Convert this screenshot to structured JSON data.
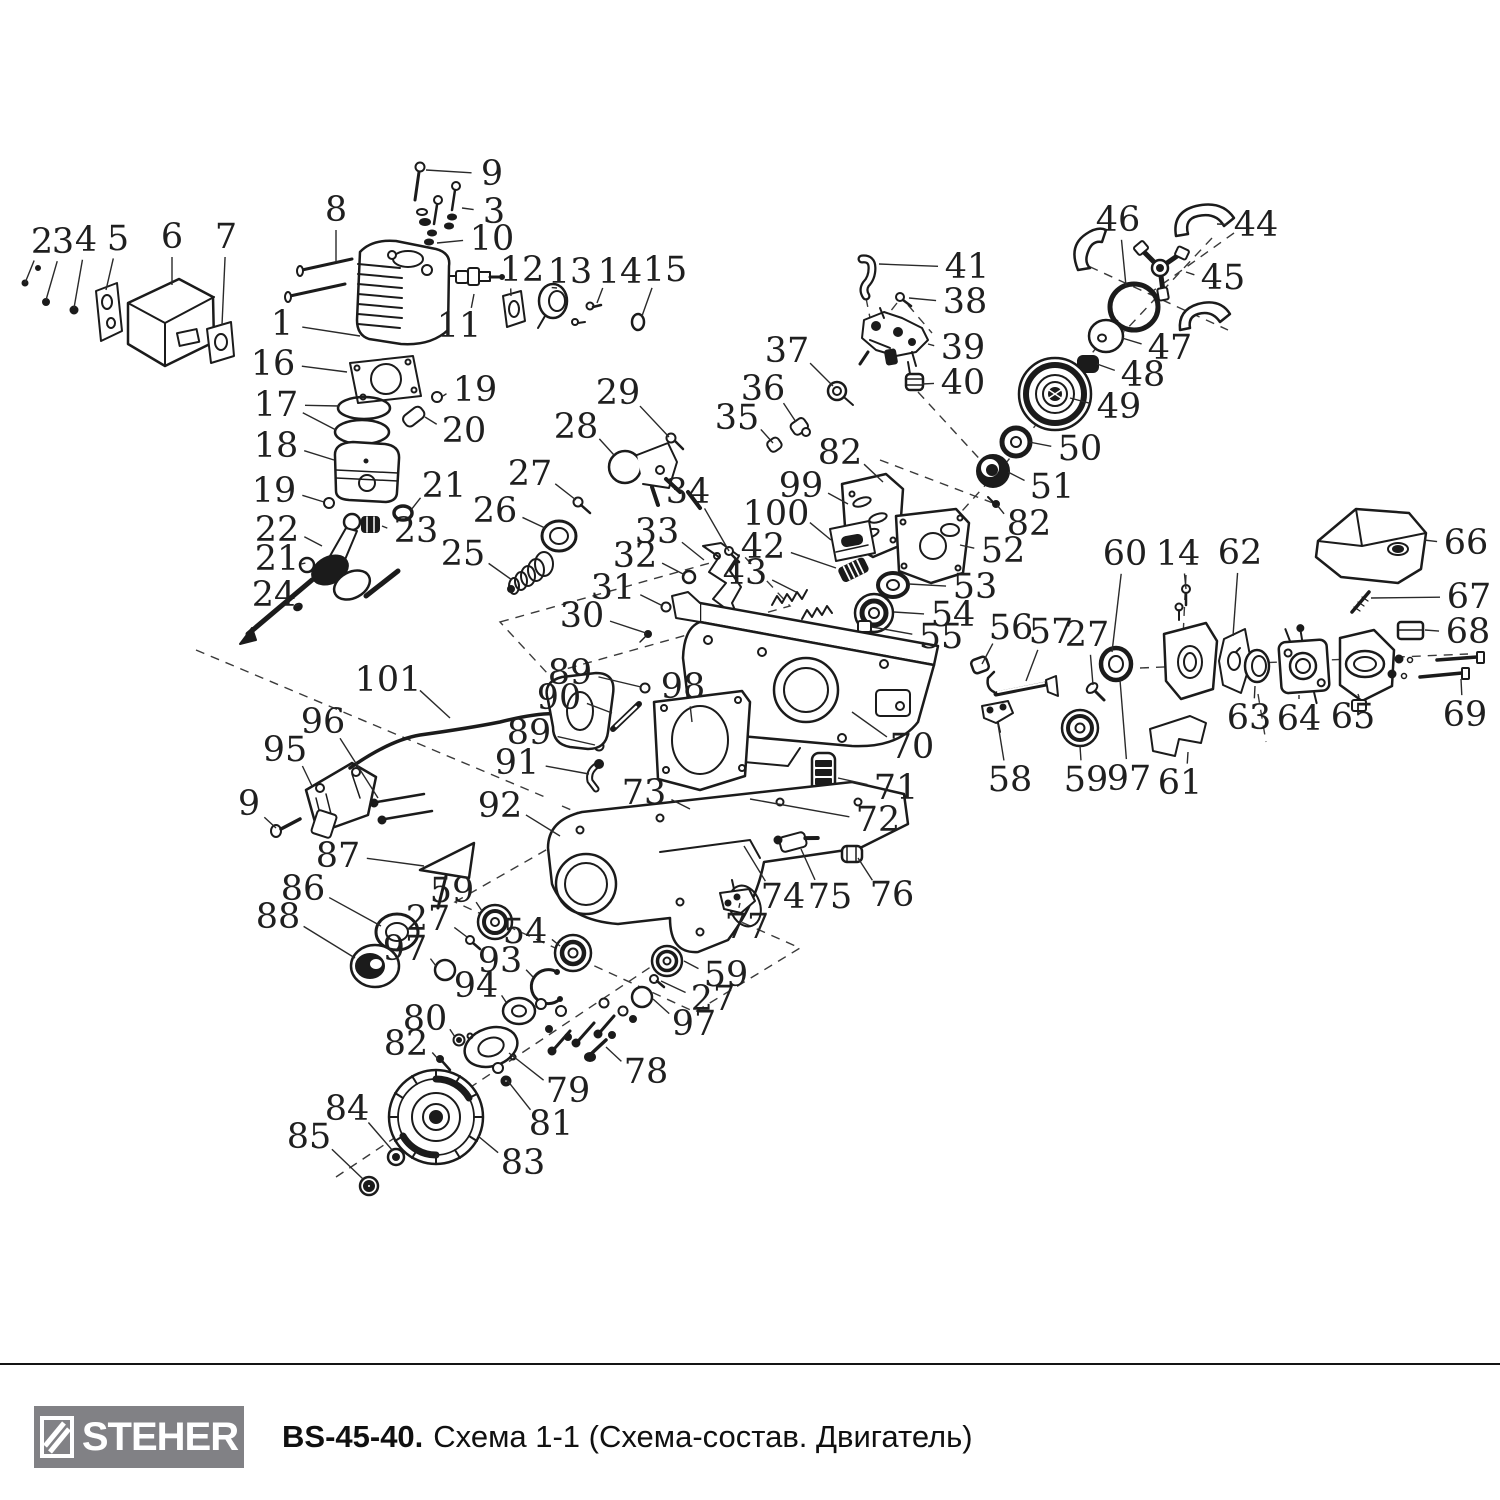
{
  "page": {
    "background": "#ffffff",
    "ink": "#1b1b1b"
  },
  "footer": {
    "brand": "STEHER",
    "model": "BS-45-40.",
    "title": "Схема 1-1 (Схема-состав. Двигатель)",
    "badge_color": "#818185",
    "rule_color": "#141414"
  },
  "diagram": {
    "description": "Exploded parts schematic of chainsaw engine (Двигатель) with numbered callouts",
    "callouts": [
      {
        "n": "2",
        "x": 42,
        "y": 242,
        "t": [
          [
            25,
            283
          ]
        ]
      },
      {
        "n": "3",
        "x": 63,
        "y": 242,
        "t": [
          [
            46,
            300
          ]
        ]
      },
      {
        "n": "4",
        "x": 86,
        "y": 240,
        "t": [
          [
            74,
            308
          ]
        ]
      },
      {
        "n": "5",
        "x": 118,
        "y": 239,
        "t": [
          [
            106,
            290
          ]
        ]
      },
      {
        "n": "6",
        "x": 172,
        "y": 237,
        "t": [
          [
            172,
            285
          ]
        ]
      },
      {
        "n": "7",
        "x": 226,
        "y": 237,
        "t": [
          [
            222,
            325
          ]
        ]
      },
      {
        "n": "8",
        "x": 336,
        "y": 210,
        "t": [
          [
            336,
            262
          ]
        ]
      },
      {
        "n": "9",
        "x": 492,
        "y": 174,
        "t": [
          [
            426,
            170
          ]
        ]
      },
      {
        "n": "3",
        "x": 494,
        "y": 212,
        "t": [
          [
            462,
            208
          ]
        ]
      },
      {
        "n": "10",
        "x": 492,
        "y": 239,
        "t": [
          [
            437,
            243
          ]
        ]
      },
      {
        "n": "1",
        "x": 282,
        "y": 324,
        "t": [
          [
            360,
            336
          ]
        ]
      },
      {
        "n": "11",
        "x": 459,
        "y": 326,
        "t": [
          [
            474,
            294
          ]
        ]
      },
      {
        "n": "12",
        "x": 522,
        "y": 270,
        "t": [
          [
            511,
            296
          ]
        ]
      },
      {
        "n": "13",
        "x": 570,
        "y": 272,
        "t": [
          [
            557,
            288
          ]
        ]
      },
      {
        "n": "14",
        "x": 620,
        "y": 272,
        "t": [
          [
            597,
            303
          ]
        ]
      },
      {
        "n": "15",
        "x": 665,
        "y": 270,
        "t": [
          [
            642,
            316
          ]
        ]
      },
      {
        "n": "16",
        "x": 273,
        "y": 364,
        "t": [
          [
            347,
            372
          ]
        ]
      },
      {
        "n": "17",
        "x": 276,
        "y": 405,
        "t": [
          [
            339,
            406
          ],
          [
            336,
            430
          ]
        ]
      },
      {
        "n": "19",
        "x": 475,
        "y": 390,
        "t": [
          [
            443,
            396
          ]
        ]
      },
      {
        "n": "20",
        "x": 464,
        "y": 431,
        "t": [
          [
            425,
            417
          ]
        ]
      },
      {
        "n": "18",
        "x": 276,
        "y": 446,
        "t": [
          [
            334,
            460
          ]
        ]
      },
      {
        "n": "19",
        "x": 274,
        "y": 491,
        "t": [
          [
            324,
            502
          ]
        ]
      },
      {
        "n": "21",
        "x": 444,
        "y": 486,
        "t": [
          [
            411,
            510
          ]
        ]
      },
      {
        "n": "22",
        "x": 277,
        "y": 530,
        "t": [
          [
            322,
            546
          ]
        ]
      },
      {
        "n": "23",
        "x": 416,
        "y": 531,
        "t": [
          [
            382,
            526
          ]
        ]
      },
      {
        "n": "21",
        "x": 277,
        "y": 559,
        "t": [
          [
            301,
            564
          ]
        ]
      },
      {
        "n": "24",
        "x": 274,
        "y": 595,
        "t": [
          [
            295,
            606
          ]
        ]
      },
      {
        "n": "25",
        "x": 463,
        "y": 554,
        "t": [
          [
            512,
            580
          ]
        ]
      },
      {
        "n": "26",
        "x": 495,
        "y": 511,
        "t": [
          [
            545,
            528
          ]
        ]
      },
      {
        "n": "27",
        "x": 530,
        "y": 474,
        "t": [
          [
            576,
            500
          ]
        ]
      },
      {
        "n": "28",
        "x": 576,
        "y": 427,
        "t": [
          [
            614,
            455
          ]
        ]
      },
      {
        "n": "29",
        "x": 618,
        "y": 393,
        "t": [
          [
            669,
            437
          ]
        ]
      },
      {
        "n": "34",
        "x": 688,
        "y": 492,
        "t": [
          [
            729,
            551
          ]
        ]
      },
      {
        "n": "33",
        "x": 657,
        "y": 532,
        "t": [
          [
            704,
            560
          ]
        ]
      },
      {
        "n": "32",
        "x": 635,
        "y": 556,
        "t": [
          [
            685,
            575
          ]
        ]
      },
      {
        "n": "31",
        "x": 613,
        "y": 588,
        "t": [
          [
            663,
            606
          ]
        ]
      },
      {
        "n": "30",
        "x": 582,
        "y": 616,
        "t": [
          [
            646,
            633
          ]
        ]
      },
      {
        "n": "35",
        "x": 737,
        "y": 418,
        "t": [
          [
            773,
            443
          ]
        ]
      },
      {
        "n": "36",
        "x": 763,
        "y": 389,
        "t": [
          [
            796,
            422
          ]
        ]
      },
      {
        "n": "37",
        "x": 787,
        "y": 351,
        "t": [
          [
            833,
            386
          ]
        ]
      },
      {
        "n": "41",
        "x": 967,
        "y": 267,
        "t": [
          [
            879,
            264
          ]
        ]
      },
      {
        "n": "38",
        "x": 965,
        "y": 302,
        "t": [
          [
            909,
            298
          ]
        ]
      },
      {
        "n": "39",
        "x": 963,
        "y": 348,
        "t": [
          [
            928,
            344
          ]
        ]
      },
      {
        "n": "40",
        "x": 963,
        "y": 383,
        "t": [
          [
            922,
            384
          ]
        ]
      },
      {
        "n": "46",
        "x": 1118,
        "y": 220,
        "t": [
          [
            1126,
            286
          ]
        ]
      },
      {
        "n": "44",
        "x": 1256,
        "y": 225,
        "t": [
          [
            1217,
            224
          ]
        ]
      },
      {
        "n": "45",
        "x": 1223,
        "y": 278,
        "t": [
          [
            1186,
            272
          ]
        ]
      },
      {
        "n": "47",
        "x": 1170,
        "y": 348,
        "t": [
          [
            1122,
            338
          ]
        ]
      },
      {
        "n": "48",
        "x": 1143,
        "y": 375,
        "t": [
          [
            1097,
            364
          ]
        ]
      },
      {
        "n": "49",
        "x": 1119,
        "y": 407,
        "t": [
          [
            1070,
            398
          ]
        ]
      },
      {
        "n": "50",
        "x": 1080,
        "y": 449,
        "t": [
          [
            1029,
            442
          ]
        ]
      },
      {
        "n": "51",
        "x": 1052,
        "y": 487,
        "t": [
          [
            1008,
            472
          ]
        ]
      },
      {
        "n": "82",
        "x": 840,
        "y": 453,
        "t": [
          [
            883,
            482
          ]
        ]
      },
      {
        "n": "99",
        "x": 801,
        "y": 486,
        "t": [
          [
            848,
            504
          ]
        ]
      },
      {
        "n": "100",
        "x": 776,
        "y": 514,
        "t": [
          [
            831,
            540
          ]
        ]
      },
      {
        "n": "42",
        "x": 763,
        "y": 547,
        "t": [
          [
            836,
            568
          ]
        ]
      },
      {
        "n": "43",
        "x": 745,
        "y": 573,
        "t": [
          [
            796,
            592
          ]
        ]
      },
      {
        "n": "82",
        "x": 1029,
        "y": 524,
        "t": [
          [
            997,
            505
          ]
        ]
      },
      {
        "n": "52",
        "x": 1003,
        "y": 551,
        "t": [
          [
            960,
            545
          ]
        ]
      },
      {
        "n": "53",
        "x": 975,
        "y": 587,
        "t": [
          [
            909,
            584
          ]
        ]
      },
      {
        "n": "54",
        "x": 953,
        "y": 615,
        "t": [
          [
            894,
            612
          ]
        ]
      },
      {
        "n": "55",
        "x": 941,
        "y": 637,
        "t": [
          [
            872,
            627
          ]
        ]
      },
      {
        "n": "56",
        "x": 1011,
        "y": 628,
        "t": [
          [
            982,
            664
          ]
        ]
      },
      {
        "n": "57",
        "x": 1051,
        "y": 632,
        "t": [
          [
            1026,
            681
          ]
        ]
      },
      {
        "n": "27",
        "x": 1087,
        "y": 635,
        "t": [
          [
            1093,
            685
          ]
        ]
      },
      {
        "n": "60",
        "x": 1125,
        "y": 554,
        "t": [
          [
            1112,
            652
          ]
        ]
      },
      {
        "n": "14",
        "x": 1178,
        "y": 554,
        "t": [
          [
            1186,
            589
          ]
        ]
      },
      {
        "n": "62",
        "x": 1240,
        "y": 553,
        "t": [
          [
            1233,
            636
          ]
        ]
      },
      {
        "n": "66",
        "x": 1466,
        "y": 543,
        "t": [
          [
            1424,
            540
          ]
        ]
      },
      {
        "n": "67",
        "x": 1469,
        "y": 597,
        "t": [
          [
            1371,
            598
          ]
        ]
      },
      {
        "n": "68",
        "x": 1468,
        "y": 632,
        "t": [
          [
            1425,
            630
          ]
        ]
      },
      {
        "n": "69",
        "x": 1465,
        "y": 715,
        "t": [
          [
            1461,
            679
          ]
        ]
      },
      {
        "n": "63",
        "x": 1249,
        "y": 718,
        "t": [
          [
            1255,
            686
          ]
        ]
      },
      {
        "n": "64",
        "x": 1299,
        "y": 719,
        "t": [
          [
            1299,
            695
          ]
        ]
      },
      {
        "n": "65",
        "x": 1353,
        "y": 717,
        "t": [
          [
            1358,
            694
          ]
        ]
      },
      {
        "n": "61",
        "x": 1180,
        "y": 783,
        "t": [
          [
            1188,
            752
          ]
        ]
      },
      {
        "n": "89",
        "x": 570,
        "y": 673,
        "t": [
          [
            641,
            687
          ]
        ]
      },
      {
        "n": "90",
        "x": 559,
        "y": 698,
        "t": [
          [
            612,
            713
          ]
        ]
      },
      {
        "n": "89",
        "x": 529,
        "y": 733,
        "t": [
          [
            595,
            745
          ]
        ]
      },
      {
        "n": "91",
        "x": 517,
        "y": 763,
        "t": [
          [
            589,
            774
          ]
        ]
      },
      {
        "n": "98",
        "x": 683,
        "y": 687,
        "t": [
          [
            692,
            722
          ]
        ]
      },
      {
        "n": "101",
        "x": 388,
        "y": 680,
        "t": [
          [
            450,
            718
          ]
        ]
      },
      {
        "n": "96",
        "x": 323,
        "y": 722,
        "t": [
          [
            378,
            798
          ]
        ]
      },
      {
        "n": "95",
        "x": 285,
        "y": 750,
        "t": [
          [
            312,
            786
          ]
        ]
      },
      {
        "n": "9",
        "x": 249,
        "y": 804,
        "t": [
          [
            276,
            828
          ]
        ]
      },
      {
        "n": "70",
        "x": 912,
        "y": 747,
        "t": [
          [
            852,
            712
          ]
        ]
      },
      {
        "n": "71",
        "x": 896,
        "y": 788,
        "t": [
          [
            838,
            778
          ]
        ]
      },
      {
        "n": "72",
        "x": 878,
        "y": 820,
        "t": [
          [
            750,
            799
          ]
        ]
      },
      {
        "n": "73",
        "x": 644,
        "y": 793,
        "t": [
          [
            690,
            809
          ]
        ]
      },
      {
        "n": "74",
        "x": 783,
        "y": 897,
        "t": [
          [
            744,
            846
          ]
        ]
      },
      {
        "n": "75",
        "x": 830,
        "y": 897,
        "t": [
          [
            801,
            849
          ]
        ]
      },
      {
        "n": "76",
        "x": 892,
        "y": 895,
        "t": [
          [
            858,
            858
          ]
        ]
      },
      {
        "n": "77",
        "x": 747,
        "y": 927,
        "t": [
          [
            740,
            903
          ]
        ]
      },
      {
        "n": "58",
        "x": 1010,
        "y": 780,
        "t": [
          [
            998,
            724
          ]
        ]
      },
      {
        "n": "59",
        "x": 1086,
        "y": 780,
        "t": [
          [
            1080,
            746
          ]
        ]
      },
      {
        "n": "97",
        "x": 1129,
        "y": 779,
        "t": [
          [
            1120,
            680
          ]
        ]
      },
      {
        "n": "87",
        "x": 338,
        "y": 856,
        "t": [
          [
            424,
            866
          ]
        ]
      },
      {
        "n": "86",
        "x": 303,
        "y": 889,
        "t": [
          [
            381,
            926
          ]
        ]
      },
      {
        "n": "88",
        "x": 278,
        "y": 917,
        "t": [
          [
            355,
            958
          ]
        ]
      },
      {
        "n": "92",
        "x": 500,
        "y": 806,
        "t": [
          [
            560,
            836
          ]
        ]
      },
      {
        "n": "59",
        "x": 452,
        "y": 891,
        "t": [
          [
            482,
            911
          ]
        ]
      },
      {
        "n": "27",
        "x": 428,
        "y": 919,
        "t": [
          [
            467,
            937
          ]
        ]
      },
      {
        "n": "97",
        "x": 405,
        "y": 949,
        "t": [
          [
            436,
            966
          ]
        ]
      },
      {
        "n": "54",
        "x": 525,
        "y": 932,
        "t": [
          [
            560,
            946
          ]
        ]
      },
      {
        "n": "93",
        "x": 500,
        "y": 961,
        "t": [
          [
            533,
            977
          ]
        ]
      },
      {
        "n": "94",
        "x": 476,
        "y": 986,
        "t": [
          [
            506,
            1002
          ]
        ]
      },
      {
        "n": "80",
        "x": 425,
        "y": 1019,
        "t": [
          [
            455,
            1037
          ]
        ]
      },
      {
        "n": "82",
        "x": 406,
        "y": 1044,
        "t": [
          [
            438,
            1059
          ]
        ]
      },
      {
        "n": "59",
        "x": 726,
        "y": 975,
        "t": [
          [
            684,
            961
          ]
        ]
      },
      {
        "n": "27",
        "x": 713,
        "y": 999,
        "t": [
          [
            661,
            981
          ]
        ]
      },
      {
        "n": "97",
        "x": 694,
        "y": 1024,
        "t": [
          [
            653,
            999
          ]
        ]
      },
      {
        "n": "78",
        "x": 646,
        "y": 1072,
        "t": [
          [
            606,
            1047
          ]
        ]
      },
      {
        "n": "79",
        "x": 568,
        "y": 1091,
        "t": [
          [
            509,
            1053
          ]
        ]
      },
      {
        "n": "81",
        "x": 551,
        "y": 1124,
        "t": [
          [
            507,
            1080
          ]
        ]
      },
      {
        "n": "84",
        "x": 347,
        "y": 1109,
        "t": [
          [
            393,
            1151
          ]
        ]
      },
      {
        "n": "85",
        "x": 309,
        "y": 1137,
        "t": [
          [
            363,
            1179
          ]
        ]
      },
      {
        "n": "83",
        "x": 523,
        "y": 1163,
        "t": [
          [
            478,
            1136
          ]
        ]
      }
    ]
  }
}
